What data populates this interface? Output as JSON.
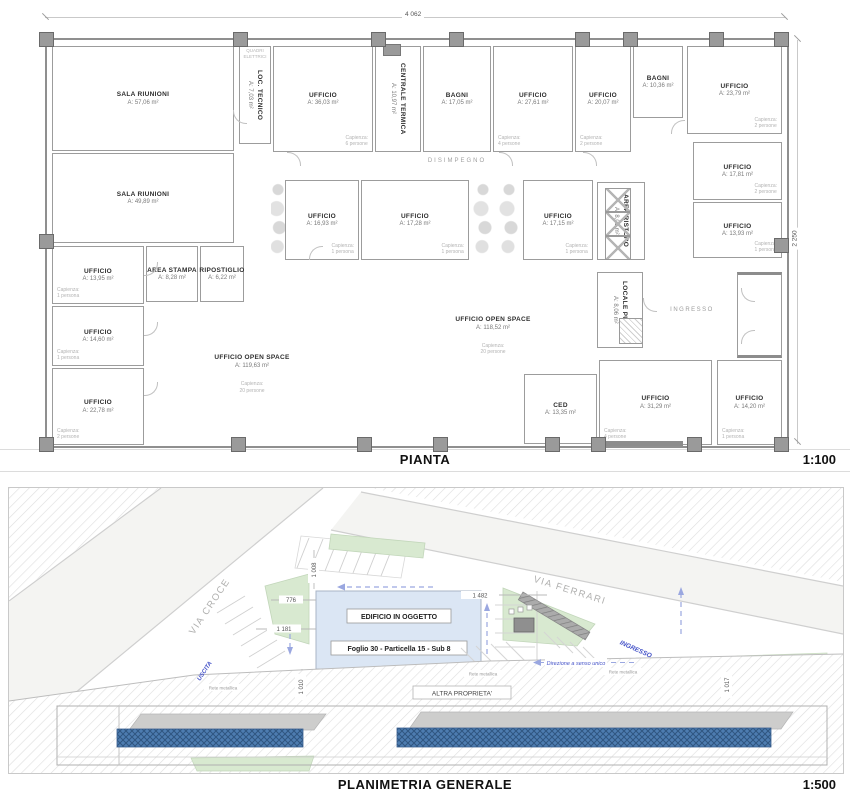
{
  "pianta": {
    "title": "PIANTA",
    "scale": "1:100",
    "dims": {
      "width": "4 062",
      "height": "2 250"
    },
    "corridor": "DISIMPEGNO",
    "electrical_panel": "QUADRI\nELETTRICI",
    "rooms": [
      {
        "name": "SALA RIUNIONI",
        "area": "A: 57,06 m²"
      },
      {
        "name": "LOC. TECNICO",
        "area": "A: 7,03 m²"
      },
      {
        "name": "UFFICIO",
        "area": "A: 36,03 m²",
        "capacity": "Capienza:\n6 persone"
      },
      {
        "name": "CENTRALE TERMICA",
        "area": "A: 10,97 m²"
      },
      {
        "name": "BAGNI",
        "area": "A: 17,05 m²"
      },
      {
        "name": "UFFICIO",
        "area": "A: 27,61 m²",
        "capacity": "Capienza:\n4 persone"
      },
      {
        "name": "UFFICIO",
        "area": "A: 20,07 m²",
        "capacity": "Capienza:\n2 persone"
      },
      {
        "name": "BAGNI",
        "area": "A: 10,36 m²"
      },
      {
        "name": "UFFICIO",
        "area": "A: 23,79 m²",
        "capacity": "Capienza:\n2 persone"
      },
      {
        "name": "SALA RIUNIONI",
        "area": "A: 49,89 m²"
      },
      {
        "name": "UFFICIO",
        "area": "A: 16,93 m²",
        "capacity": "Capienza:\n1 persona"
      },
      {
        "name": "UFFICIO",
        "area": "A: 17,28 m²",
        "capacity": "Capienza:\n1 persona"
      },
      {
        "name": "UFFICIO",
        "area": "A: 17,15 m²",
        "capacity": "Capienza:\n1 persona"
      },
      {
        "name": "AREA RISTORO",
        "area": "A: 8,01 m²"
      },
      {
        "name": "UFFICIO",
        "area": "A: 17,81 m²",
        "capacity": "Capienza:\n2 persone"
      },
      {
        "name": "UFFICIO",
        "area": "A: 13,93 m²",
        "capacity": "Capienza:\n1 persona"
      },
      {
        "name": "UFFICIO",
        "area": "A: 13,95 m²",
        "capacity": "Capienza:\n1 persona"
      },
      {
        "name": "AREA STAMPA",
        "area": "A: 8,28 m²"
      },
      {
        "name": "RIPOSTIGLIO",
        "area": "A: 6,22 m²"
      },
      {
        "name": "UFFICIO",
        "area": "A: 14,60 m²",
        "capacity": "Capienza:\n1 persona"
      },
      {
        "name": "UFFICIO",
        "area": "A: 22,78 m²",
        "capacity": "Capienza:\n2 persone"
      },
      {
        "name": "UFFICIO OPEN SPACE",
        "area": "A: 119,63 m²",
        "capacity": "Capienza:\n20 persone"
      },
      {
        "name": "UFFICIO OPEN SPACE",
        "area": "A: 118,52 m²",
        "capacity": "Capienza:\n20 persone"
      },
      {
        "name": "LOCALE PULIZIE",
        "area": "A: 8,06 m²"
      },
      {
        "name": "INGRESSO"
      },
      {
        "name": "CED",
        "area": "A: 13,35 m²"
      },
      {
        "name": "UFFICIO",
        "area": "A: 31,29 m²",
        "capacity": "Capienza:\n4 persone"
      },
      {
        "name": "UFFICIO",
        "area": "A: 14,20 m²",
        "capacity": "Capienza:\n1 persona"
      }
    ]
  },
  "planimetria": {
    "title": "PLANIMETRIA GENERALE",
    "scale": "1:500",
    "building": {
      "label": "EDIFICIO IN OGGETTO",
      "cadastral": "Foglio 30 - Particella 15 - Sub 8"
    },
    "roads": {
      "west": "VIA CROCE",
      "north": "VIA FERRARI"
    },
    "annotations": {
      "exit": "USCITA",
      "entrance": "INGRESSO",
      "one_way": "Direzione a senso unico",
      "other_property": "ALTRA PROPRIETA'",
      "fence": "Rete metallica"
    },
    "dims": {
      "d1": "1 008",
      "d2": "776",
      "d3": "1 181",
      "d4": "1 010",
      "d5": "1 482",
      "d6": "1 017"
    }
  },
  "colors": {
    "building_fill": "#dbe6f4",
    "green": "#d8e9d0",
    "annotation_blue": "#4553c8",
    "roof_blue": "#4d7cb0"
  }
}
